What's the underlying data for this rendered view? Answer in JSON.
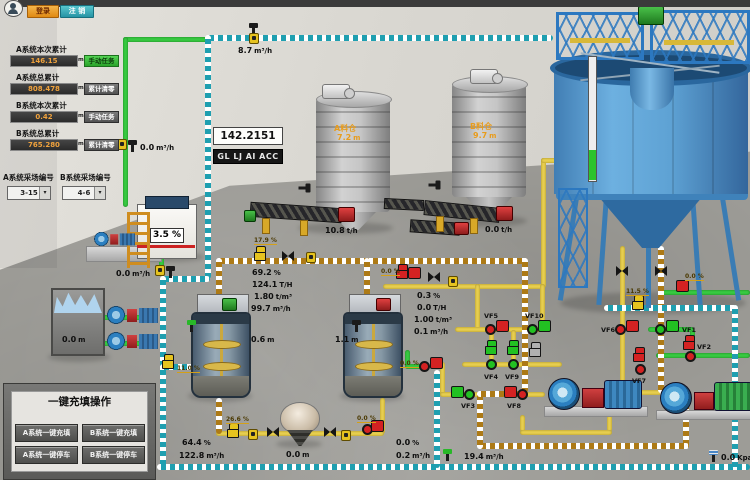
{
  "header": {
    "login": "登录",
    "logout": "注 销"
  },
  "accumulators": {
    "rows": [
      {
        "label": "A系统本次累计",
        "value": "146.15",
        "unit": "m³",
        "action": "手动任务"
      },
      {
        "label": "A系统总累计",
        "value": "808.478",
        "unit": "m³",
        "action": "累计清零"
      },
      {
        "label": "B系统本次累计",
        "value": "0.42",
        "unit": "m³",
        "action": "手动任务"
      },
      {
        "label": "B系统总累计",
        "value": "765.280",
        "unit": "m³",
        "action": "累计清零"
      }
    ],
    "selectors": [
      {
        "label": "A系统采场编号",
        "value": "3-15"
      },
      {
        "label": "B系统采场编号",
        "value": "4-6"
      }
    ]
  },
  "display": {
    "value": "142.2151",
    "code": "GL LJ AI ACC"
  },
  "silos": {
    "a": {
      "name": "A料仓",
      "level": "7.2",
      "level_unit": "m",
      "rate": "10.8",
      "rate_unit": "t/h"
    },
    "b": {
      "name": "B料仓",
      "level": "9.7",
      "level_unit": "m",
      "rate": "0.0",
      "rate_unit": "t/h"
    }
  },
  "values": {
    "flow_top": {
      "v": "8.7",
      "u": "m³/h"
    },
    "flow_left_upper": {
      "v": "0.0",
      "u": "m³/h"
    },
    "flow_left_lower": {
      "v": "0.0",
      "u": "m³/h"
    },
    "tank_level": {
      "v": "3.5",
      "u": "%"
    },
    "bin_level": {
      "v": "0.0",
      "u": "m"
    },
    "line_a": [
      {
        "v": "69.2",
        "u": "%"
      },
      {
        "v": "124.1",
        "u": "T/H"
      },
      {
        "v": "1.80",
        "u": "t/m³"
      },
      {
        "v": "99.7",
        "u": "m³/h"
      }
    ],
    "line_b": [
      {
        "v": "0.3",
        "u": "%"
      },
      {
        "v": "0.0",
        "u": "T/H"
      },
      {
        "v": "1.00",
        "u": "t/m³"
      },
      {
        "v": "0.1",
        "u": "m³/h"
      }
    ],
    "mixer1_level": {
      "v": "0.6",
      "u": "m"
    },
    "mixer2_level": {
      "v": "1.1",
      "u": "m"
    },
    "fill_pct": {
      "v": "64.4",
      "u": "%"
    },
    "fill_flow": {
      "v": "122.8",
      "u": "m³/h"
    },
    "hopper_level": {
      "v": "0.0",
      "u": "m"
    },
    "b_out_pct": {
      "v": "0.0",
      "u": "%"
    },
    "b_out_flow": {
      "v": "0.2",
      "u": "m³/h"
    },
    "drain_flow": {
      "v": "19.4",
      "u": "m³/h"
    },
    "pressure": {
      "v": "0.0",
      "u": "Kpa"
    }
  },
  "tags": {
    "a_valve": "17.9 %",
    "b_valve": "0.0 %",
    "mixer_feed": "11.0 %",
    "mixer2_out": "0.0 %",
    "bottom_valve": "26.6 %",
    "bottom_out": "0.0 %",
    "right_valve": "11.5 %",
    "right_pump": "0.0 %"
  },
  "valves": {
    "vf1": "VF1",
    "vf2": "VF2",
    "vf3": "VF3",
    "vf4": "VF4",
    "vf5": "VF5",
    "vf6": "VF6",
    "vf7": "VF7",
    "vf8": "VF8",
    "vf9": "VF9",
    "vf10": "VF10"
  },
  "control_panel": {
    "title": "一键充填操作",
    "buttons": [
      "A系统一键充填",
      "B系统一键充填",
      "A系统一键停车",
      "B系统一键停车"
    ]
  }
}
